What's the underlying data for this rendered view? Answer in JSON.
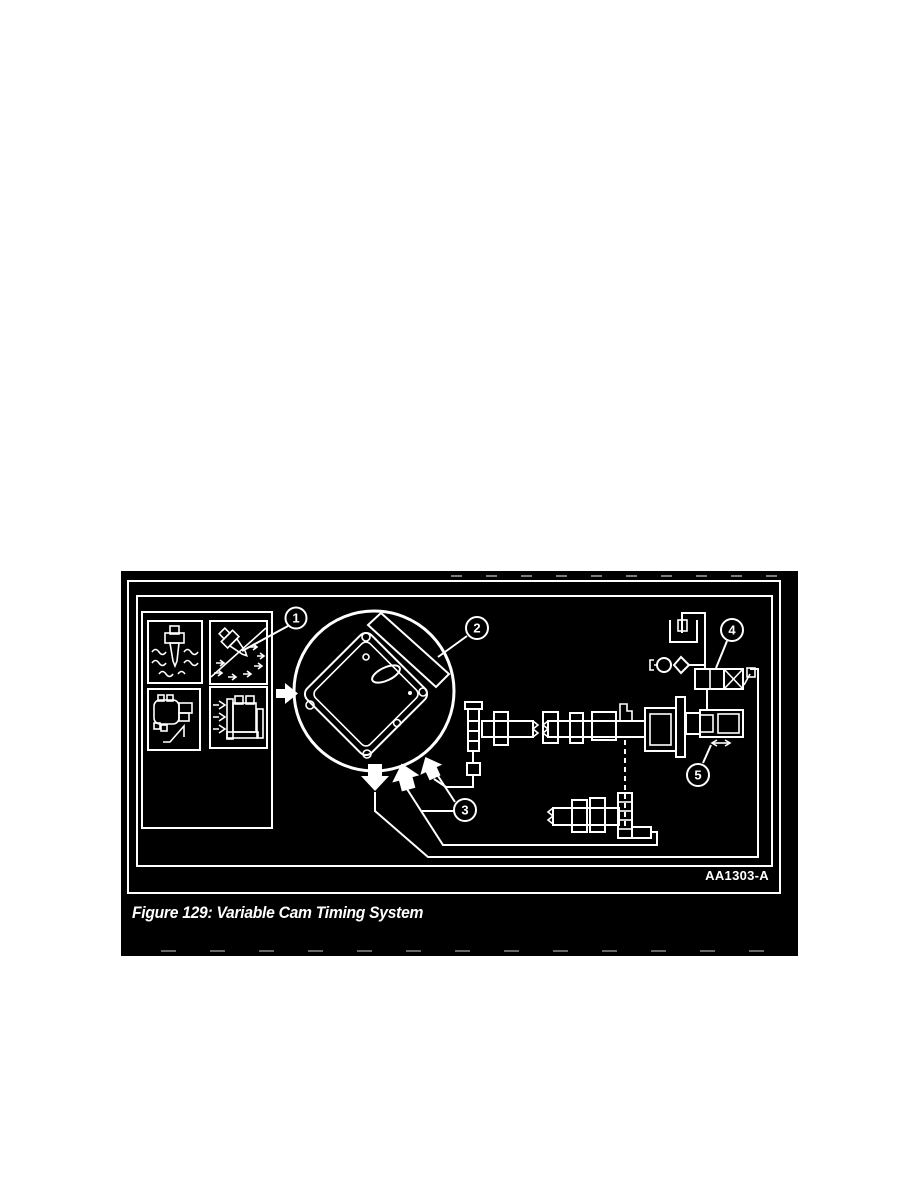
{
  "figure": {
    "caption": "Figure 129: Variable Cam Timing System",
    "part_code": "AA1303-A",
    "callouts": [
      "1",
      "2",
      "3",
      "4",
      "5"
    ],
    "colors": {
      "page_bg": "#ffffff",
      "figure_bg": "#000000",
      "line_color": "#ffffff"
    }
  }
}
